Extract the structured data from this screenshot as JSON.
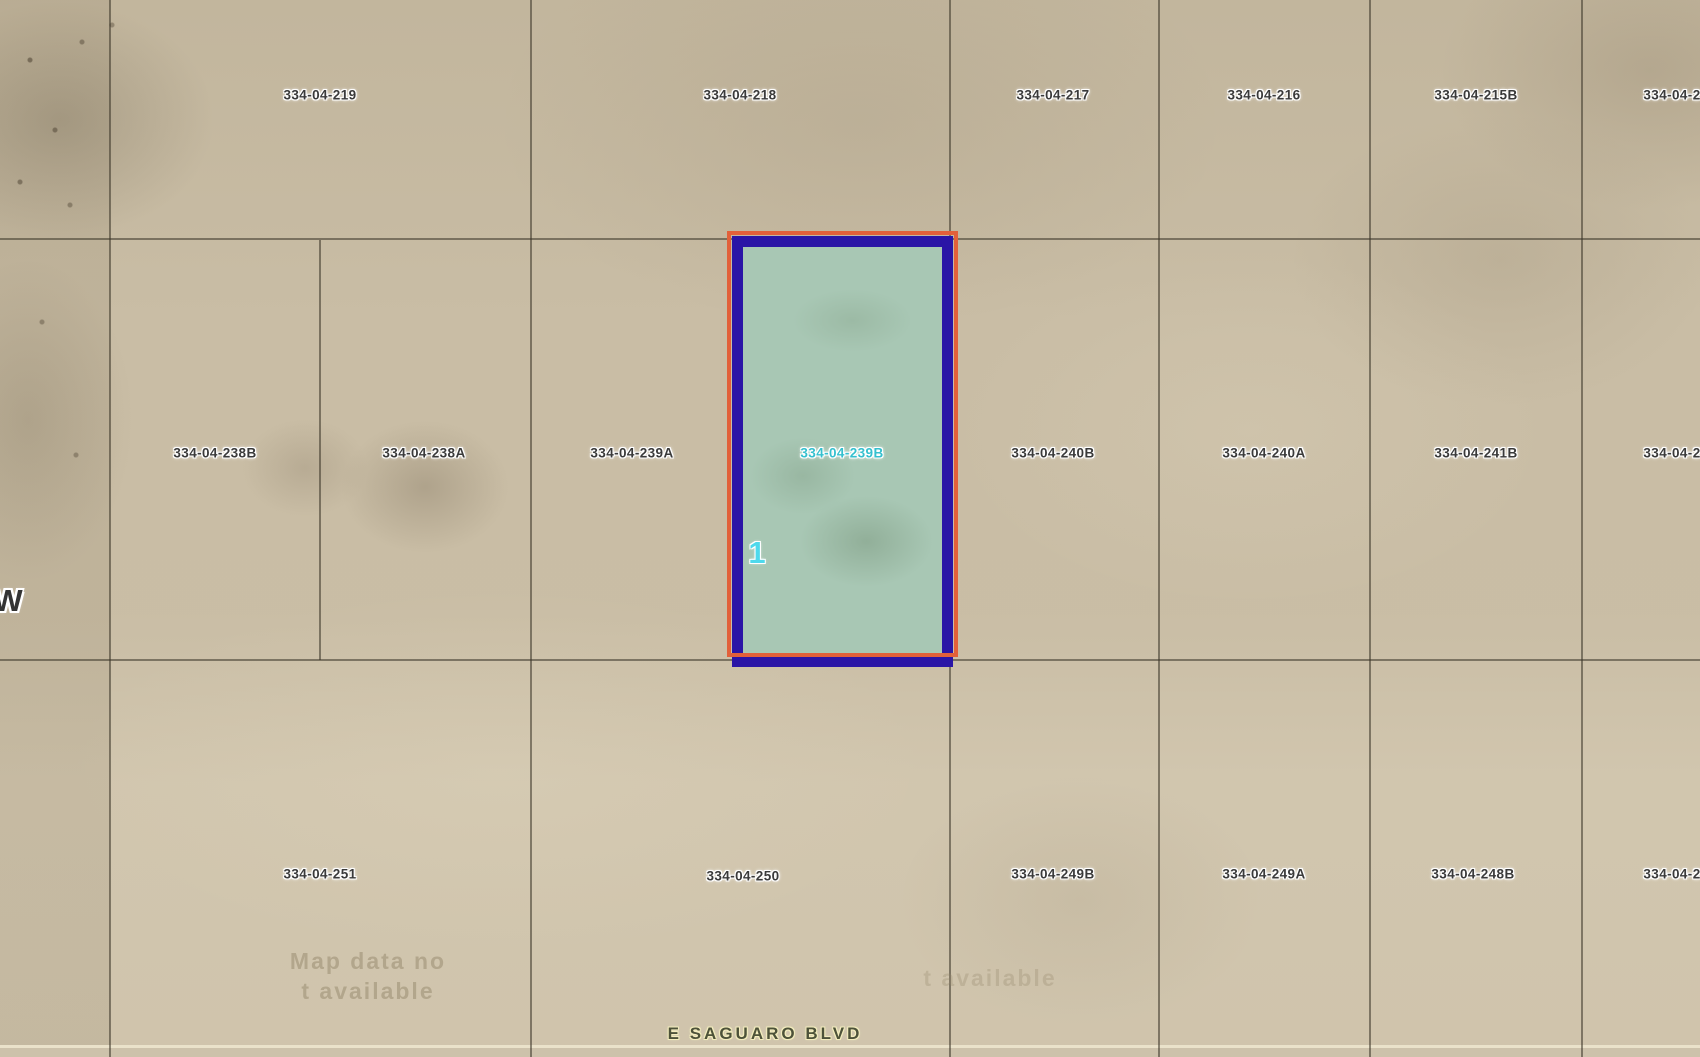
{
  "canvas": {
    "width": 1700,
    "height": 1057
  },
  "map": {
    "colors": {
      "terrain": "#c9bda5",
      "grid_line": "rgba(58,52,40,0.55)",
      "selected_fill": "#a8c7b4",
      "selected_border_inner": "#2a15a6",
      "selected_border_outer": "#e2603a",
      "parcel_label": "#3a3a3a",
      "selected_label": "#35c0ce",
      "street_label": "#4d5239",
      "road_line": "#eae2ca"
    },
    "parcel_labels": [
      {
        "id": "334-04-219",
        "x": 320,
        "y": 95
      },
      {
        "id": "334-04-218",
        "x": 740,
        "y": 95
      },
      {
        "id": "334-04-217",
        "x": 1053,
        "y": 95
      },
      {
        "id": "334-04-216",
        "x": 1264,
        "y": 95
      },
      {
        "id": "334-04-215B",
        "x": 1476,
        "y": 95
      },
      {
        "id": "334-04-2",
        "x": 1672,
        "y": 95,
        "partial": true
      },
      {
        "id": "334-04-238B",
        "x": 215,
        "y": 453
      },
      {
        "id": "334-04-238A",
        "x": 424,
        "y": 453
      },
      {
        "id": "334-04-239A",
        "x": 632,
        "y": 453
      },
      {
        "id": "334-04-239B",
        "x": 842,
        "y": 453,
        "selected": true
      },
      {
        "id": "334-04-240B",
        "x": 1053,
        "y": 453
      },
      {
        "id": "334-04-240A",
        "x": 1264,
        "y": 453
      },
      {
        "id": "334-04-241B",
        "x": 1476,
        "y": 453
      },
      {
        "id": "334-04-2",
        "x": 1672,
        "y": 453,
        "partial": true
      },
      {
        "id": "334-04-251",
        "x": 320,
        "y": 874
      },
      {
        "id": "334-04-250",
        "x": 743,
        "y": 876
      },
      {
        "id": "334-04-249B",
        "x": 1053,
        "y": 874
      },
      {
        "id": "334-04-249A",
        "x": 1264,
        "y": 874
      },
      {
        "id": "334-04-248B",
        "x": 1473,
        "y": 874
      },
      {
        "id": "334-04-2",
        "x": 1672,
        "y": 874,
        "partial": true
      }
    ],
    "selected_parcel": {
      "id": "334-04-239B",
      "marker": "1",
      "outer_box": {
        "x": 727,
        "y": 231,
        "w": 231,
        "h": 426
      },
      "inner_box": {
        "x": 732,
        "y": 236,
        "w": 221,
        "h": 431
      },
      "marker_pos": {
        "x": 757,
        "y": 553
      }
    },
    "street": {
      "label": "E SAGUARO BLVD",
      "x": 765,
      "y": 1034
    },
    "edge_label": {
      "text": "W",
      "x": 8,
      "y": 601
    },
    "watermarks": [
      {
        "lines": [
          "Map data no",
          "t available"
        ],
        "x": 368,
        "y": 976,
        "opacity": 0.5
      },
      {
        "lines": [
          "t available"
        ],
        "x": 990,
        "y": 978,
        "opacity": 0.3
      }
    ],
    "grid": {
      "v_lines": [
        {
          "x": 110,
          "y1": 0,
          "y2": 1057
        },
        {
          "x": 320,
          "y1": 240,
          "y2": 660
        },
        {
          "x": 531,
          "y1": 0,
          "y2": 1057
        },
        {
          "x": 950,
          "y1": 0,
          "y2": 1057
        },
        {
          "x": 1159,
          "y1": 0,
          "y2": 1057
        },
        {
          "x": 1370,
          "y1": 0,
          "y2": 1057
        },
        {
          "x": 1582,
          "y1": 0,
          "y2": 1057
        }
      ],
      "h_lines": [
        {
          "y": 239,
          "x1": 0,
          "x2": 1700
        },
        {
          "y": 660,
          "x1": 0,
          "x2": 1700
        }
      ],
      "road_line_y": 1045
    }
  }
}
